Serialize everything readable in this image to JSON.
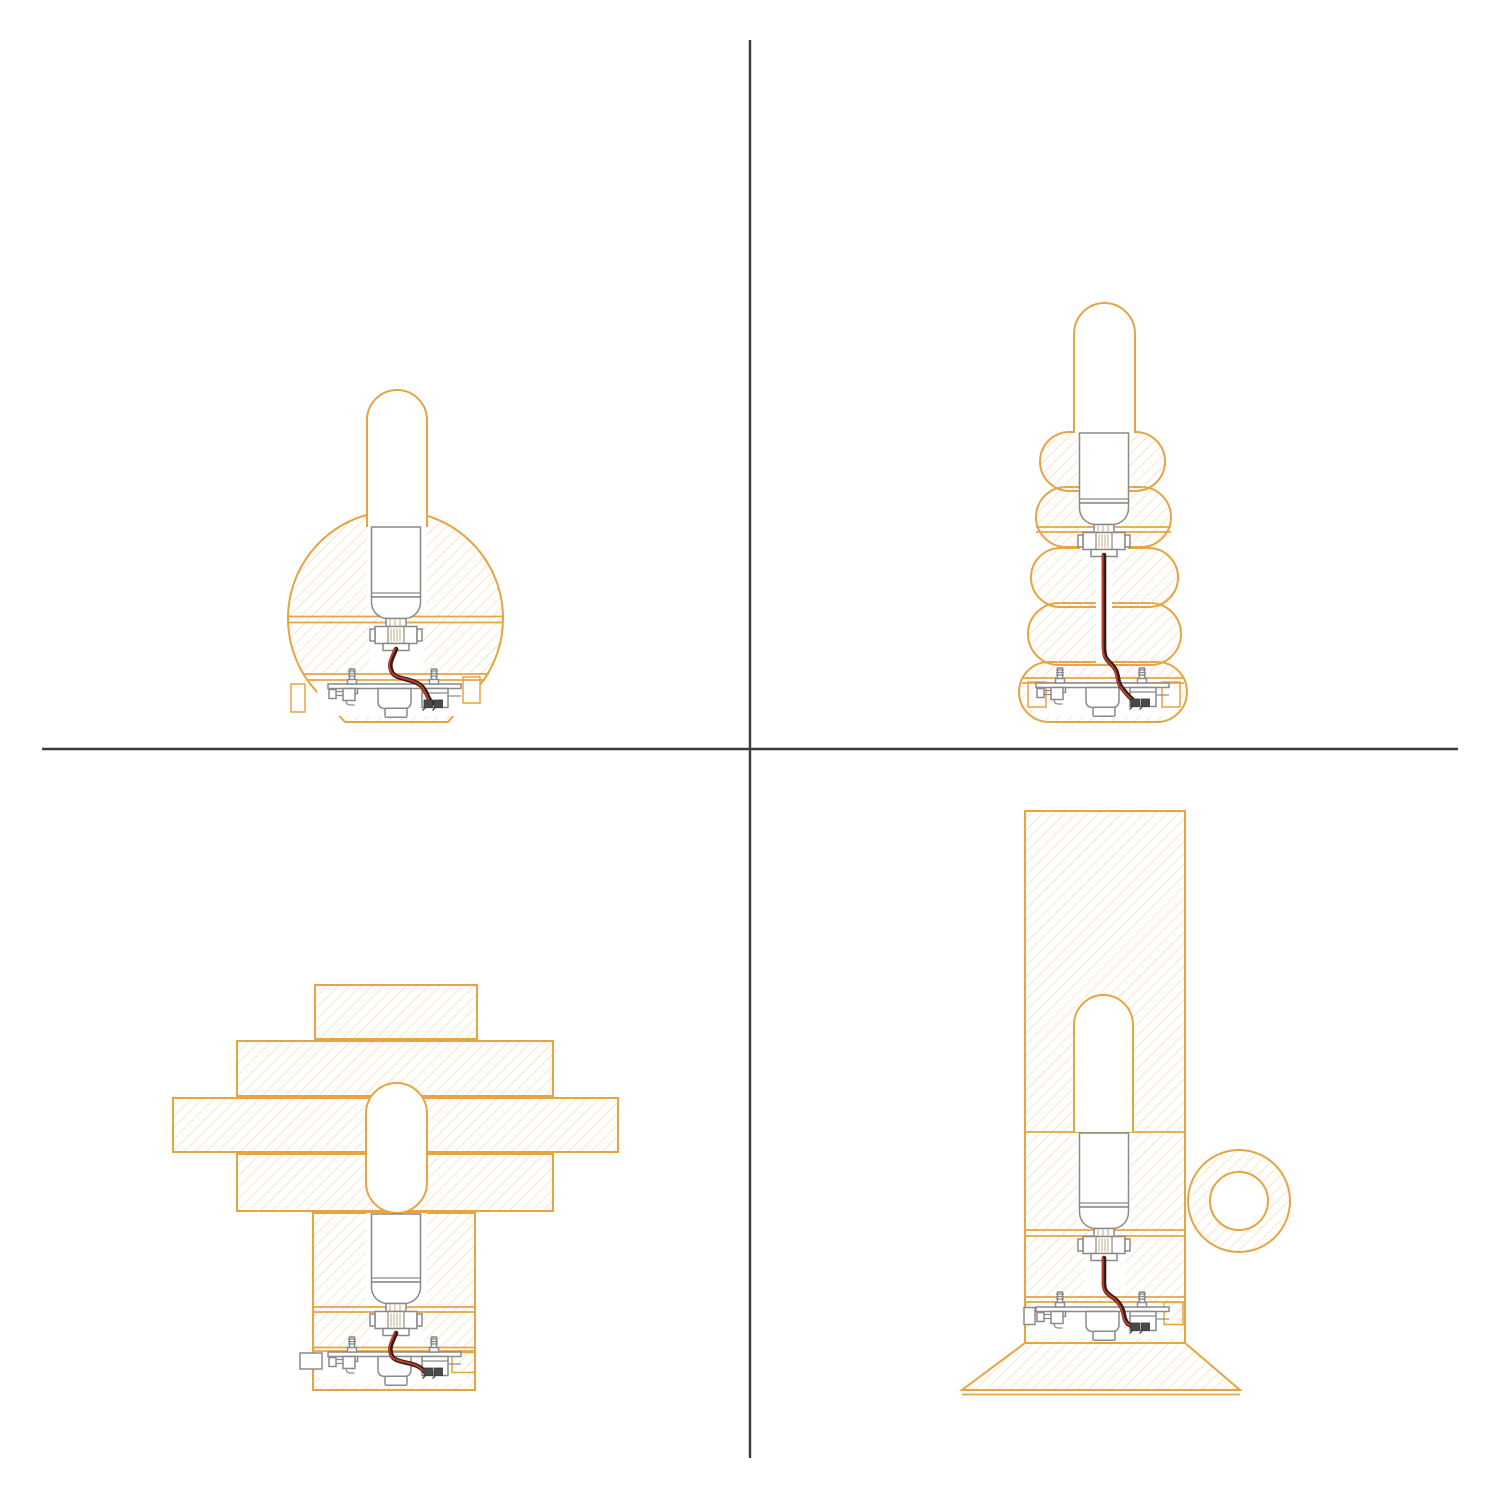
{
  "sheet": {
    "description": "Four lamp design cross-section technical drawings arranged in a 2x2 grid",
    "grid": "2x2"
  },
  "colors": {
    "background": "#ffffff",
    "outline_orange": "#E6A443",
    "hatch_orange": "#F3D2A4",
    "linework_gray": "#8A8A8A",
    "linework_dark": "#4A4A4A",
    "thread_tan": "#CBB28A",
    "wire_red": "#C23B28",
    "wire_black": "#2F1F1B",
    "divider": "#3B3B3B"
  },
  "panels": [
    {
      "position": "top-left",
      "subject": "sphere-body lamp cross-section"
    },
    {
      "position": "top-right",
      "subject": "stacked-bubble lamp cross-section"
    },
    {
      "position": "bottom-left",
      "subject": "stepped-slab lamp cross-section"
    },
    {
      "position": "bottom-right",
      "subject": "cylinder lamp with ring handle and flared base cross-section"
    }
  ],
  "shared_components": [
    "tubular bulb",
    "lamp socket",
    "red-black power wire",
    "base mechanism plate with bolts and terminal block"
  ]
}
